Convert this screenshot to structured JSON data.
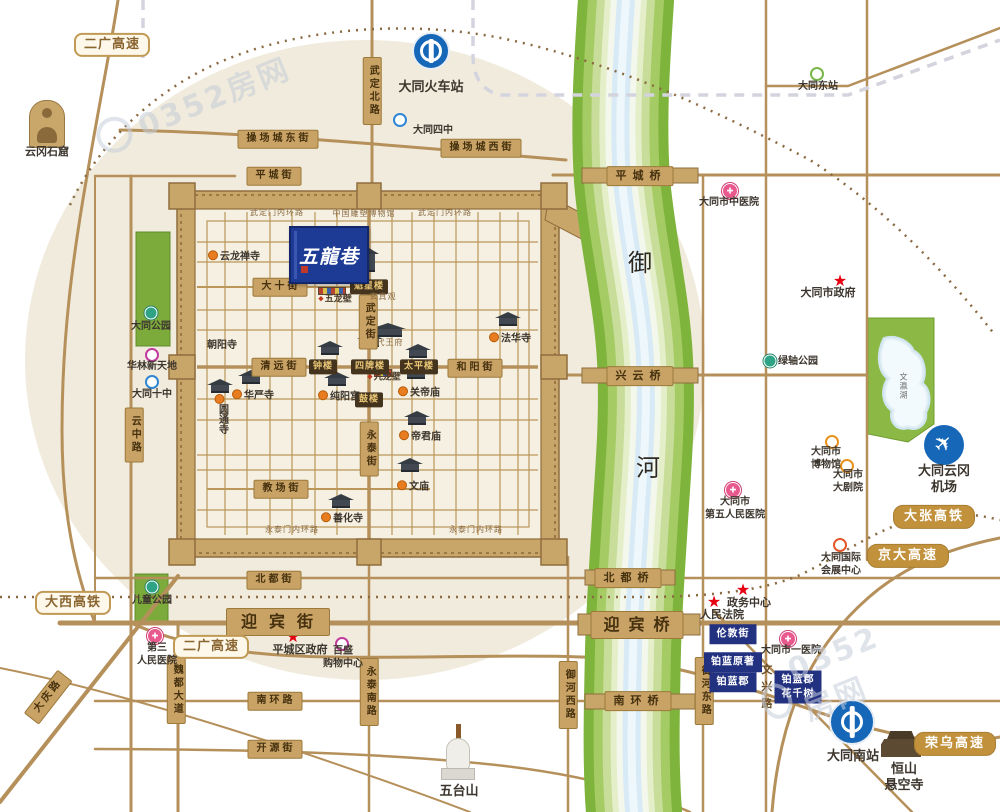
{
  "banner": {
    "text": "五龍巷"
  },
  "watermark": {
    "text": "0352房网"
  },
  "labels": [
    {
      "n": "road-label",
      "t": "r",
      "x": 278,
      "y": 139,
      "s": "操场城东街"
    },
    {
      "n": "road-label",
      "t": "r",
      "x": 481,
      "y": 148,
      "s": "操场城西街"
    },
    {
      "n": "road-label",
      "t": "r",
      "x": 274,
      "y": 176,
      "s": "平城街"
    },
    {
      "n": "road-label",
      "t": "r",
      "x": 280,
      "y": 287,
      "s": "大十街"
    },
    {
      "n": "road-label",
      "t": "r",
      "x": 279,
      "y": 367,
      "s": "清远街"
    },
    {
      "n": "road-label",
      "t": "r",
      "x": 475,
      "y": 368,
      "s": "和阳街"
    },
    {
      "n": "road-label",
      "t": "r",
      "x": 281,
      "y": 489,
      "s": "教场街"
    },
    {
      "n": "road-label",
      "t": "r",
      "x": 274,
      "y": 580,
      "s": "北都街"
    },
    {
      "n": "road-label",
      "t": "rl",
      "x": 278,
      "y": 622,
      "s": "迎宾街"
    },
    {
      "n": "road-label",
      "t": "r",
      "x": 275,
      "y": 701,
      "s": "南环路"
    },
    {
      "n": "road-label",
      "t": "r",
      "x": 275,
      "y": 749,
      "s": "开源街"
    },
    {
      "n": "road-label",
      "t": "rv",
      "x": 372,
      "y": 91,
      "s": "武定北路"
    },
    {
      "n": "road-label",
      "t": "rv",
      "x": 368,
      "y": 322,
      "s": "武定街"
    },
    {
      "n": "road-label",
      "t": "rv",
      "x": 369,
      "y": 449,
      "s": "永泰街"
    },
    {
      "n": "road-label",
      "t": "rv",
      "x": 134,
      "y": 435,
      "s": "云中路"
    },
    {
      "n": "road-label",
      "t": "rv",
      "x": 176,
      "y": 690,
      "s": "魏都大道"
    },
    {
      "n": "road-label",
      "t": "rv",
      "x": 369,
      "y": 692,
      "s": "永泰南路"
    },
    {
      "n": "road-label",
      "t": "rv",
      "x": 568,
      "y": 695,
      "s": "御河西路"
    },
    {
      "n": "road-label",
      "t": "rv",
      "x": 704,
      "y": 691,
      "s": "御河东路"
    },
    {
      "n": "road-label",
      "t": "r",
      "x": 48,
      "y": 697,
      "s": "大庆路",
      "r": -52
    },
    {
      "n": "street-label",
      "t": "tv",
      "x": 766,
      "y": 689,
      "s": "文兴路"
    },
    {
      "n": "bridge-label",
      "t": "b",
      "x": 640,
      "y": 176,
      "s": "平城桥"
    },
    {
      "n": "bridge-label",
      "t": "b",
      "x": 640,
      "y": 376,
      "s": "兴云桥"
    },
    {
      "n": "bridge-label",
      "t": "b",
      "x": 628,
      "y": 578,
      "s": "北都桥"
    },
    {
      "n": "bridge-label",
      "t": "bx",
      "x": 637,
      "y": 625,
      "s": "迎宾桥"
    },
    {
      "n": "bridge-label",
      "t": "b",
      "x": 638,
      "y": 701,
      "s": "南环桥"
    },
    {
      "n": "expressway-badge",
      "t": "hw",
      "x": 934,
      "y": 517,
      "s": "大张高铁"
    },
    {
      "n": "expressway-badge",
      "t": "hw",
      "x": 908,
      "y": 556,
      "s": "京大高速"
    },
    {
      "n": "expressway-badge",
      "t": "hw",
      "x": 955,
      "y": 744,
      "s": "荣乌高速"
    },
    {
      "n": "expressway-badge",
      "t": "ho",
      "x": 112,
      "y": 45,
      "s": "二广高速"
    },
    {
      "n": "expressway-badge",
      "t": "ho",
      "x": 73,
      "y": 603,
      "s": "大西高铁"
    },
    {
      "n": "expressway-badge",
      "t": "ho",
      "x": 211,
      "y": 647,
      "s": "二广高速"
    },
    {
      "n": "tower-badge",
      "t": "dk",
      "x": 369,
      "y": 287,
      "s": "魁星楼"
    },
    {
      "n": "tower-badge",
      "t": "dk",
      "x": 323,
      "y": 367,
      "s": "钟楼"
    },
    {
      "n": "tower-badge",
      "t": "dk",
      "x": 370,
      "y": 367,
      "s": "四牌楼"
    },
    {
      "n": "tower-badge",
      "t": "dk",
      "x": 419,
      "y": 367,
      "s": "太平楼"
    },
    {
      "n": "tower-badge",
      "t": "dk",
      "x": 369,
      "y": 400,
      "s": "鼓楼"
    },
    {
      "n": "project-badge",
      "t": "bl",
      "x": 733,
      "y": 634,
      "s": "伦敦街"
    },
    {
      "n": "project-badge",
      "t": "bl",
      "x": 733,
      "y": 662,
      "s": "铂蓝原著"
    },
    {
      "n": "project-badge",
      "t": "bl",
      "x": 733,
      "y": 682,
      "s": "铂蓝郡"
    },
    {
      "n": "project-badge",
      "t": "bl",
      "x": 798,
      "y": 687,
      "s": "铂蓝郡\n花千树"
    },
    {
      "n": "poi-label",
      "t": "t",
      "x": 47,
      "y": 152,
      "s": "云冈石窟"
    },
    {
      "n": "station-label",
      "t": "tl",
      "x": 431,
      "y": 88,
      "s": "大同火车站"
    },
    {
      "n": "school-label",
      "t": "sm",
      "x": 433,
      "y": 131,
      "s": "大同四中"
    },
    {
      "n": "station-label",
      "t": "sm",
      "x": 818,
      "y": 87,
      "s": "大同东站"
    },
    {
      "n": "hospital-label",
      "t": "sm",
      "x": 729,
      "y": 203,
      "s": "大同市中医院"
    },
    {
      "n": "government-label",
      "t": "t",
      "x": 828,
      "y": 293,
      "s": "大同市政府"
    },
    {
      "n": "park-label",
      "t": "sm",
      "x": 798,
      "y": 362,
      "s": "绿轴公园"
    },
    {
      "n": "poi-label",
      "t": "sm",
      "x": 826,
      "y": 459,
      "s": "大同市\n博物馆"
    },
    {
      "n": "poi-label",
      "t": "sm",
      "x": 848,
      "y": 482,
      "s": "大同市\n大剧院"
    },
    {
      "n": "hospital-label",
      "t": "sm",
      "x": 735,
      "y": 509,
      "s": "大同市\n第五人民医院"
    },
    {
      "n": "poi-label",
      "t": "sm",
      "x": 841,
      "y": 565,
      "s": "大同国际\n会展中心"
    },
    {
      "n": "government-label",
      "t": "t",
      "x": 749,
      "y": 603,
      "s": "政务中心"
    },
    {
      "n": "government-label",
      "t": "t",
      "x": 722,
      "y": 615,
      "s": "人民法院"
    },
    {
      "n": "hospital-label",
      "t": "sm",
      "x": 791,
      "y": 651,
      "s": "大同市一医院"
    },
    {
      "n": "airport-label",
      "t": "tl",
      "x": 944,
      "y": 480,
      "s": "大同云冈机场"
    },
    {
      "n": "station-label",
      "t": "tl",
      "x": 853,
      "y": 757,
      "s": "大同南站"
    },
    {
      "n": "temple-label",
      "t": "tl",
      "x": 904,
      "y": 778,
      "s": "恒山\n悬空寺"
    },
    {
      "n": "poi-label",
      "t": "tl",
      "x": 459,
      "y": 792,
      "s": "五台山"
    },
    {
      "n": "hospital-label",
      "t": "sm",
      "x": 157,
      "y": 655,
      "s": "第三\n人民医院"
    },
    {
      "n": "government-label",
      "t": "t",
      "x": 300,
      "y": 650,
      "s": "平城区政府"
    },
    {
      "n": "poi-label",
      "t": "sm",
      "x": 343,
      "y": 658,
      "s": "百盛\n购物中心"
    },
    {
      "n": "poi-label",
      "t": "sm",
      "x": 152,
      "y": 367,
      "s": "华林新天地"
    },
    {
      "n": "school-label",
      "t": "sm",
      "x": 152,
      "y": 395,
      "s": "大同十中"
    },
    {
      "n": "park-label",
      "t": "sm",
      "x": 151,
      "y": 327,
      "s": "大同公园"
    },
    {
      "n": "park-label",
      "t": "sm",
      "x": 152,
      "y": 601,
      "s": "儿童公园"
    },
    {
      "n": "temple-label",
      "t": "tpl",
      "x": 234,
      "y": 257,
      "s": "云龙禅寺"
    },
    {
      "n": "temple-label",
      "t": "sm",
      "x": 222,
      "y": 346,
      "s": "朝阳寺"
    },
    {
      "n": "temple-label",
      "t": "tpl",
      "x": 253,
      "y": 396,
      "s": "华严寺"
    },
    {
      "n": "temple-label",
      "t": "tplv",
      "x": 221,
      "y": 414,
      "s": "圆通寺"
    },
    {
      "n": "temple-label",
      "t": "tpl",
      "x": 339,
      "y": 397,
      "s": "纯阳宫"
    },
    {
      "n": "temple-label",
      "t": "tpl",
      "x": 419,
      "y": 393,
      "s": "关帝庙"
    },
    {
      "n": "temple-label",
      "t": "tpl",
      "x": 420,
      "y": 437,
      "s": "帝君庙"
    },
    {
      "n": "temple-label",
      "t": "tpl",
      "x": 413,
      "y": 487,
      "s": "文庙"
    },
    {
      "n": "temple-label",
      "t": "tpl",
      "x": 342,
      "y": 519,
      "s": "善化寺"
    },
    {
      "n": "temple-label",
      "t": "tpl",
      "x": 510,
      "y": 339,
      "s": "法华寺"
    },
    {
      "n": "temple-label",
      "t": "ts",
      "x": 383,
      "y": 297,
      "s": "玄真观"
    },
    {
      "n": "temple-label",
      "t": "ts",
      "x": 390,
      "y": 343,
      "s": "代王府"
    },
    {
      "n": "poi-label",
      "t": "dia",
      "x": 335,
      "y": 300,
      "s": "五龙壁"
    },
    {
      "n": "poi-label",
      "t": "dia",
      "x": 384,
      "y": 378,
      "s": "九龙壁"
    },
    {
      "n": "poi-label",
      "t": "ts",
      "x": 364,
      "y": 214,
      "s": "中国雕塑博物馆"
    },
    {
      "n": "street-label",
      "t": "ts",
      "x": 277,
      "y": 213,
      "s": "武定门内环路"
    },
    {
      "n": "street-label",
      "t": "ts",
      "x": 445,
      "y": 213,
      "s": "武定门内环路"
    },
    {
      "n": "street-label",
      "t": "ts",
      "x": 292,
      "y": 530,
      "s": "永泰门内环路"
    },
    {
      "n": "street-label",
      "t": "ts",
      "x": 476,
      "y": 530,
      "s": "永泰门内环路"
    },
    {
      "n": "lake-label",
      "t": "tsv",
      "x": 903,
      "y": 386,
      "s": "文瀛湖"
    },
    {
      "n": "river-label",
      "t": "rc",
      "x": 640,
      "y": 263,
      "s": "御"
    },
    {
      "n": "river-label",
      "t": "rc",
      "x": 648,
      "y": 468,
      "s": "河"
    }
  ],
  "markers": [
    {
      "n": "train-station-icon",
      "c": "train",
      "x": 431,
      "y": 51
    },
    {
      "n": "train-station-icon",
      "c": "train big",
      "x": 852,
      "y": 722
    },
    {
      "n": "airplane-icon",
      "c": "plane",
      "x": 944,
      "y": 445
    },
    {
      "n": "hospital-icon",
      "c": "hosp",
      "x": 730,
      "y": 191
    },
    {
      "n": "hospital-icon",
      "c": "hosp",
      "x": 733,
      "y": 490
    },
    {
      "n": "hospital-icon",
      "c": "hosp",
      "x": 155,
      "y": 636
    },
    {
      "n": "hospital-icon",
      "c": "hosp",
      "x": 788,
      "y": 639
    },
    {
      "n": "star-icon",
      "c": "star",
      "x": 840,
      "y": 281
    },
    {
      "n": "star-icon",
      "c": "star",
      "x": 743,
      "y": 590
    },
    {
      "n": "star-icon",
      "c": "star",
      "x": 714,
      "y": 602
    },
    {
      "n": "star-icon",
      "c": "star",
      "x": 293,
      "y": 637
    },
    {
      "n": "school-icon",
      "c": "ring blue",
      "x": 400,
      "y": 120
    },
    {
      "n": "school-icon",
      "c": "ring blue",
      "x": 152,
      "y": 382
    },
    {
      "n": "station-icon",
      "c": "ring green",
      "x": 817,
      "y": 74
    },
    {
      "n": "park-icon",
      "c": "pk",
      "x": 151,
      "y": 313
    },
    {
      "n": "park-icon",
      "c": "pk",
      "x": 152,
      "y": 587
    },
    {
      "n": "park-icon",
      "c": "pk",
      "x": 770,
      "y": 361
    },
    {
      "n": "shop-icon",
      "c": "ring shop",
      "x": 152,
      "y": 355
    },
    {
      "n": "shop-icon",
      "c": "ring shop",
      "x": 342,
      "y": 644
    },
    {
      "n": "culture-icon",
      "c": "ring cult",
      "x": 832,
      "y": 442
    },
    {
      "n": "culture-icon",
      "c": "ring cult",
      "x": 847,
      "y": 466
    },
    {
      "n": "exhibition-icon",
      "c": "ring ex",
      "x": 840,
      "y": 545
    },
    {
      "n": "temple-icon",
      "c": "temple",
      "x": 330,
      "y": 349
    },
    {
      "n": "temple-icon",
      "c": "temple",
      "x": 370,
      "y": 341
    },
    {
      "n": "temple-icon",
      "c": "temple",
      "x": 418,
      "y": 352
    },
    {
      "n": "temple-icon",
      "c": "temple",
      "x": 251,
      "y": 378
    },
    {
      "n": "temple-icon",
      "c": "temple",
      "x": 337,
      "y": 380
    },
    {
      "n": "temple-icon",
      "c": "temple",
      "x": 416,
      "y": 373
    },
    {
      "n": "temple-icon",
      "c": "temple",
      "x": 417,
      "y": 419
    },
    {
      "n": "temple-icon",
      "c": "temple",
      "x": 410,
      "y": 466
    },
    {
      "n": "temple-icon",
      "c": "temple",
      "x": 341,
      "y": 502
    },
    {
      "n": "temple-icon",
      "c": "temple",
      "x": 508,
      "y": 320
    },
    {
      "n": "temple-icon",
      "c": "temple",
      "x": 220,
      "y": 387
    },
    {
      "n": "temple-icon",
      "c": "temple wide",
      "x": 388,
      "y": 331
    },
    {
      "n": "temple-icon",
      "c": "temple tall",
      "x": 369,
      "y": 261
    },
    {
      "n": "wall-relief-icon",
      "c": "strip",
      "x": 332,
      "y": 291,
      "w": 26
    },
    {
      "n": "wall-relief-icon",
      "c": "strip",
      "x": 383,
      "y": 373,
      "w": 16
    },
    {
      "n": "buddha-icon",
      "c": "buddha",
      "x": 47,
      "y": 124
    },
    {
      "n": "pagoda-icon",
      "c": "stupa",
      "x": 458,
      "y": 752
    },
    {
      "n": "hanging-temple-icon",
      "c": "hang",
      "x": 901,
      "y": 744
    }
  ]
}
